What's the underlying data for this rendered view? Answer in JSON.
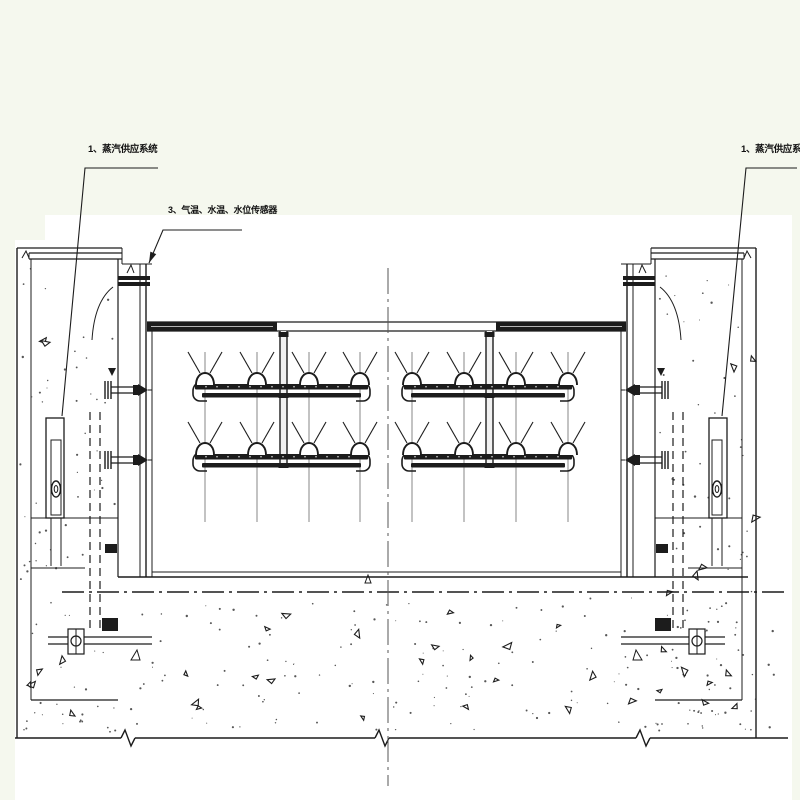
{
  "colors": {
    "page_bg": "#f5f8ee",
    "canvas": "#ffffff",
    "ink": "#1c1c1c",
    "thin_line": "#6f6f6f",
    "text": "#111111"
  },
  "annotations": {
    "steam_left": {
      "text": "1、蒸汽供应系统",
      "tx": 88,
      "ty": 152,
      "leader": [
        [
          158,
          168
        ],
        [
          85,
          168
        ],
        [
          62,
          416
        ]
      ],
      "arrow": false
    },
    "sensors": {
      "text": "3、气温、水温、水位传感器",
      "tx": 168,
      "ty": 213,
      "leader": [
        [
          242,
          230
        ],
        [
          163,
          230
        ],
        [
          149,
          263
        ]
      ],
      "arrow": true
    },
    "steam_right": {
      "text": "1、蒸汽供应系统",
      "tx": 741,
      "ty": 152,
      "leader": [
        [
          797,
          168
        ],
        [
          746,
          168
        ],
        [
          722,
          416
        ]
      ],
      "arrow": false
    }
  },
  "diagram": {
    "type": "engineering-section-drawing",
    "canvas": {
      "x": 15,
      "y": 215,
      "w": 777,
      "h": 585,
      "notch_x": 45,
      "notch_y": 240
    },
    "centerline_x": 388,
    "mirror_x": 773,
    "gate": {
      "x1": 145,
      "x2": 628,
      "top": 322,
      "bottom": 577,
      "rail_xs": [
        140,
        146,
        152
      ]
    },
    "top_band": {
      "y1": 322,
      "y2": 331,
      "solid": [
        [
          147,
          277
        ],
        [
          496,
          626
        ]
      ]
    },
    "feed_pipes": {
      "x": [
        283.5,
        489.5
      ],
      "y1": 331,
      "y2": 466,
      "w": 7
    },
    "manifold_rows": [
      390,
      460
    ],
    "manifolds": [
      {
        "x1": 195,
        "x2": 368,
        "nozzles": [
          205,
          257,
          309,
          360
        ]
      },
      {
        "x1": 404,
        "x2": 572,
        "nozzles": [
          412,
          464,
          516,
          568
        ]
      }
    ],
    "nozzle_column_line": {
      "y1": 352,
      "y2": 522
    },
    "pier": {
      "outer_x": 17,
      "inner_x": 31,
      "slot_x": 118,
      "top_y": 248,
      "cap_y1": 253,
      "cap_y2": 259,
      "shelf_y": 518,
      "ledge_y": 568,
      "bottom_y": 700
    },
    "heater": {
      "x": 46,
      "y": 418,
      "w": 18,
      "h": 100
    },
    "bolt_rows": [
      390,
      460
    ],
    "ground": {
      "top_y": 577,
      "axis_y": 592,
      "bottom_y": 738,
      "breaks": [
        128,
        382,
        643
      ],
      "left_x": 15,
      "right_x": 788
    }
  }
}
